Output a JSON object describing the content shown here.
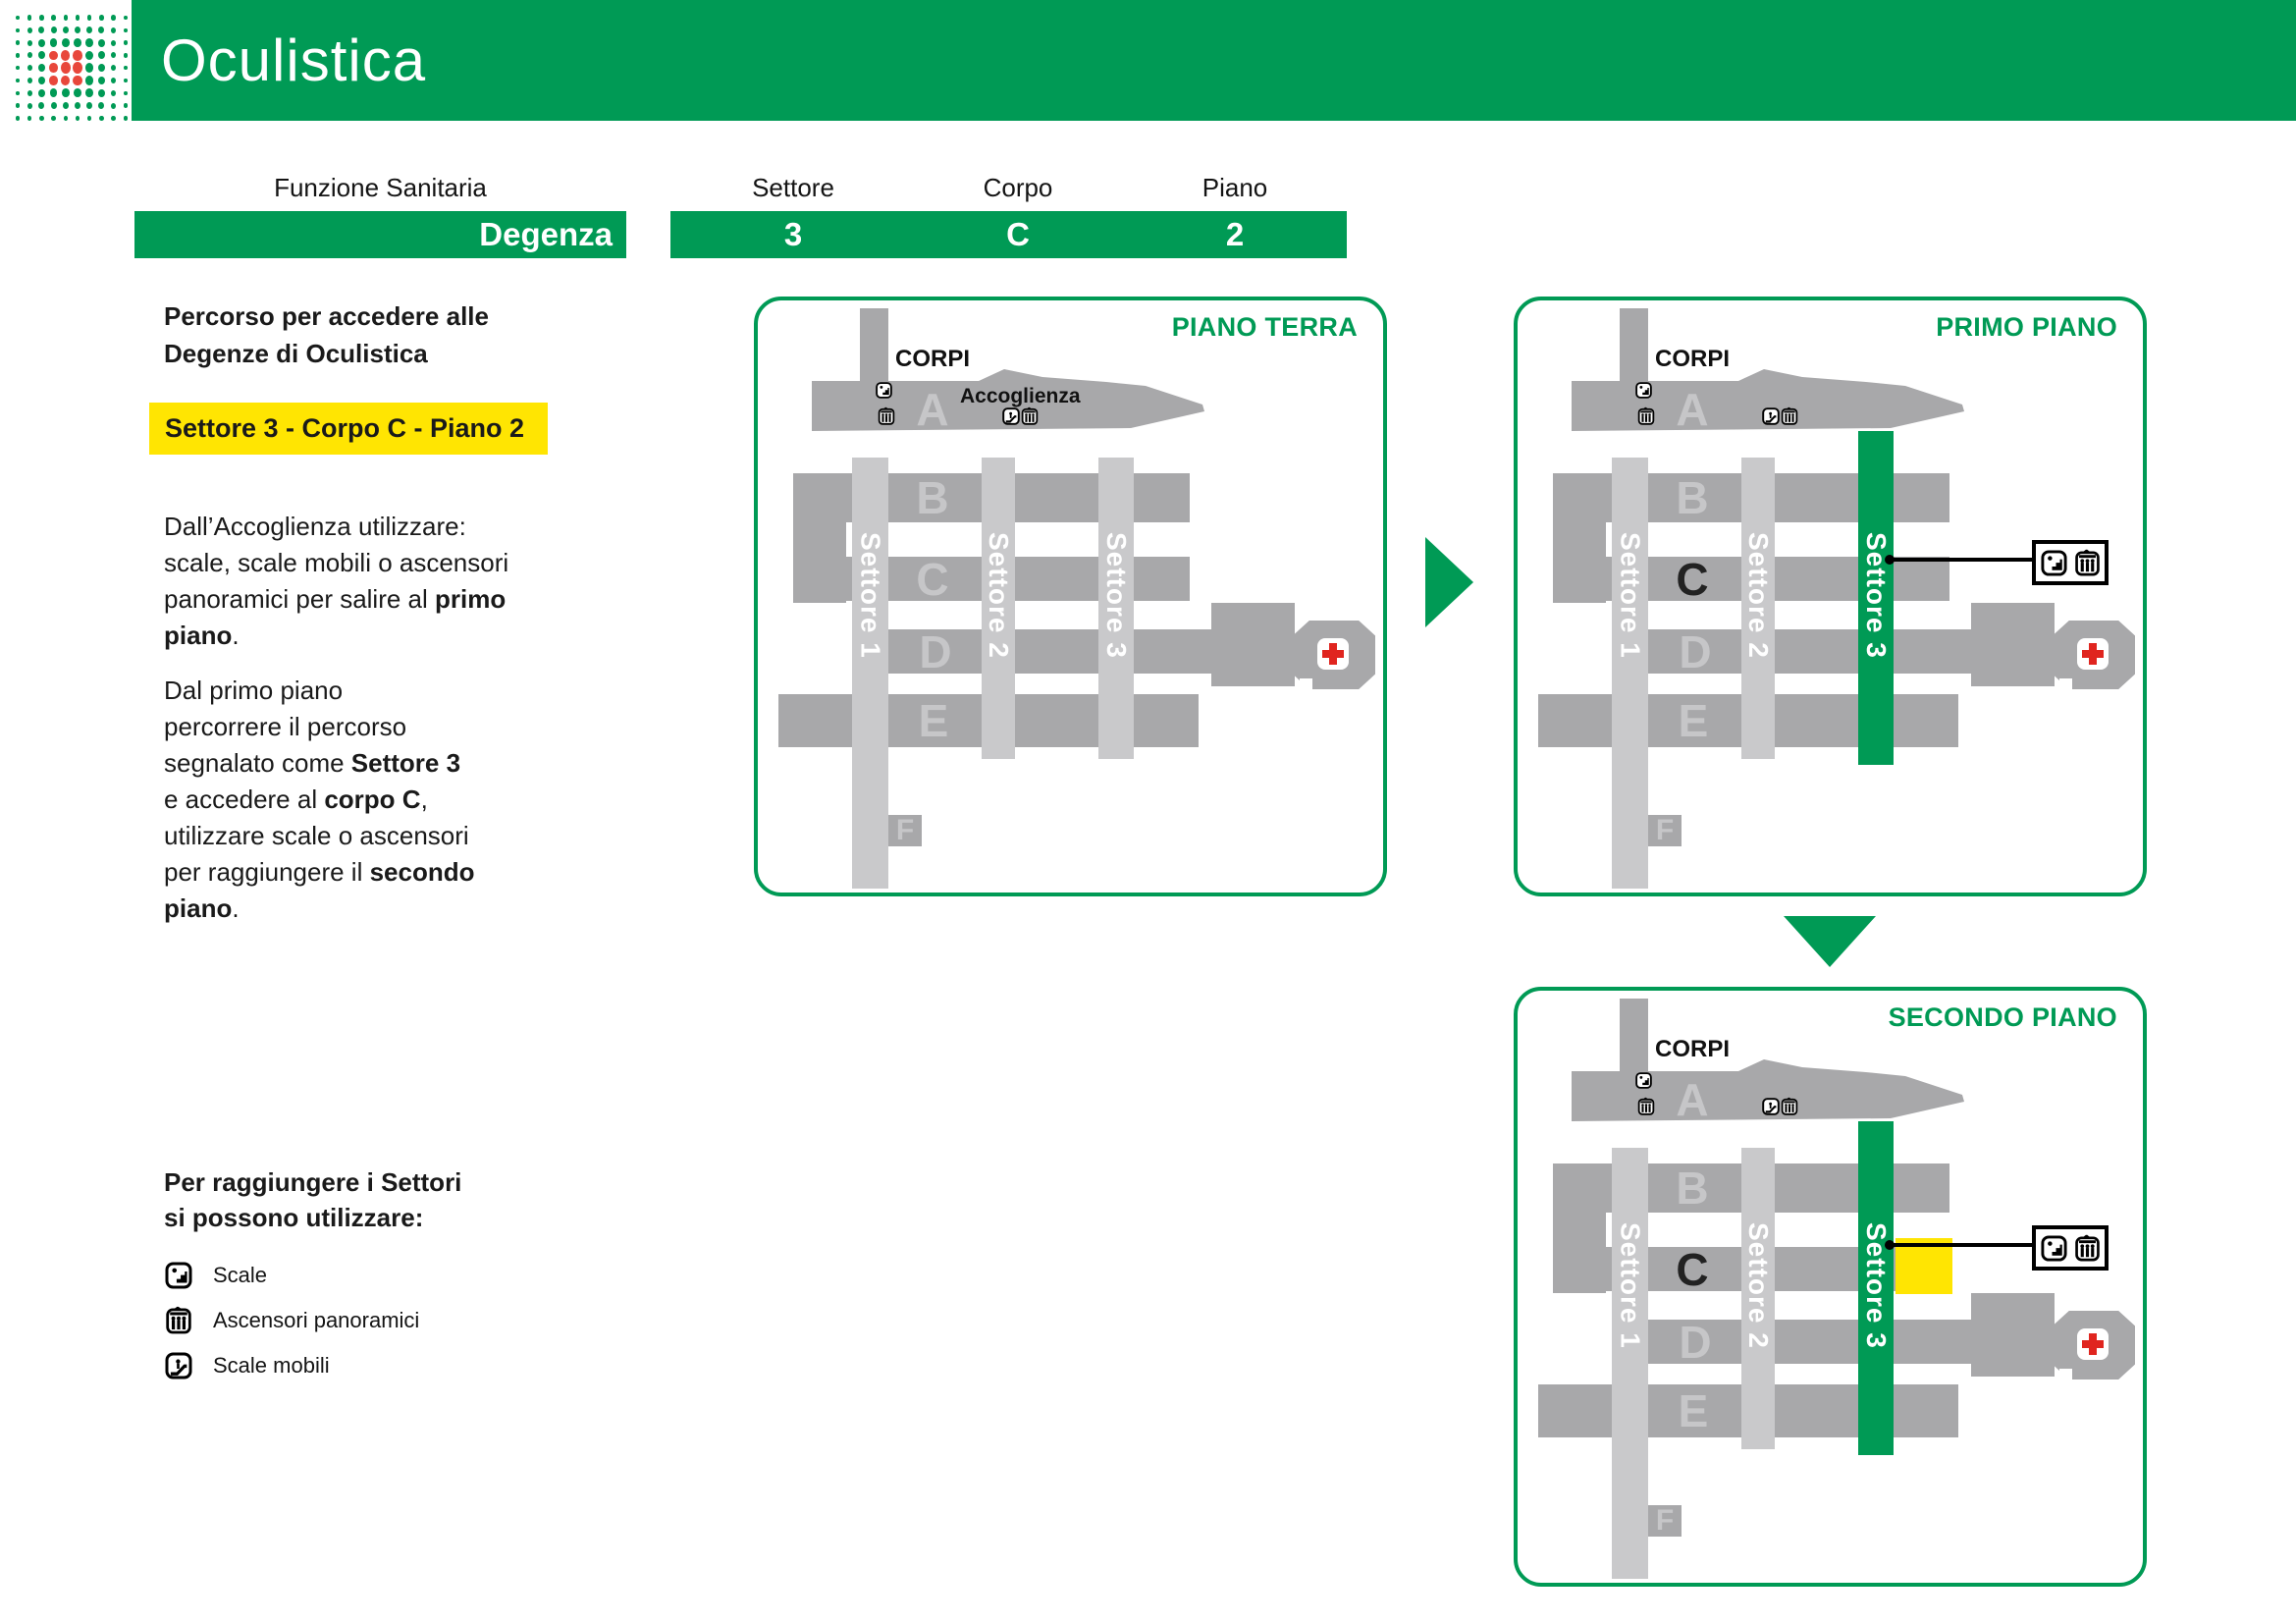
{
  "header": {
    "title": "Oculistica"
  },
  "table": {
    "function_header": "Funzione Sanitaria",
    "function_value": "Degenza",
    "location_headers": [
      "Settore",
      "Corpo",
      "Piano"
    ],
    "location_values": [
      "3",
      "C",
      "2"
    ]
  },
  "sidebar": {
    "heading_lines": [
      "Percorso per accedere alle",
      "Degenze di Oculistica"
    ],
    "highlight": "Settore 3 - Corpo C - Piano 2",
    "para1_lines": [
      [
        [
          "Dall’Accoglienza utilizzare:",
          0
        ]
      ],
      [
        [
          "scale, scale mobili o ascensori",
          0
        ]
      ],
      [
        [
          "panoramici per salire al ",
          0
        ],
        [
          "primo",
          1
        ]
      ],
      [
        [
          "piano",
          1
        ],
        [
          ".",
          0
        ]
      ]
    ],
    "para2_lines": [
      [
        [
          "Dal primo piano",
          0
        ]
      ],
      [
        [
          "percorrere il percorso",
          0
        ]
      ],
      [
        [
          "segnalato come ",
          0
        ],
        [
          "Settore 3",
          1
        ]
      ],
      [
        [
          "e accedere al ",
          0
        ],
        [
          "corpo C",
          1
        ],
        [
          ",",
          0
        ]
      ],
      [
        [
          "utilizzare scale o ascensori",
          0
        ]
      ],
      [
        [
          "per raggiungere il ",
          0
        ],
        [
          "secondo",
          1
        ]
      ],
      [
        [
          "piano",
          1
        ],
        [
          ".",
          0
        ]
      ]
    ],
    "legend_heading_lines": [
      "Per raggiungere i Settori",
      "si possono utilizzare:"
    ],
    "legend": [
      {
        "icon": "stairs-icon",
        "label": "Scale"
      },
      {
        "icon": "panoramic-elevator-icon",
        "label": "Ascensori panoramici"
      },
      {
        "icon": "escalator-icon",
        "label": "Scale mobili"
      }
    ]
  },
  "floors": [
    {
      "title": "PIANO TERRA"
    },
    {
      "title": "PRIMO PIANO"
    },
    {
      "title": "SECONDO PIANO"
    }
  ],
  "map": {
    "corpi_label": "CORPI",
    "accoglienza_label": "Accoglienza",
    "letters": [
      "A",
      "B",
      "C",
      "D",
      "E",
      "F"
    ],
    "sectors": [
      "Settore 1",
      "Settore 2",
      "Settore 3"
    ]
  },
  "colors": {
    "green": "#009a55",
    "band_gray": "#a8a8aa",
    "strip_gray": "#c9c9cb",
    "letter_gray": "#c6c6c8",
    "yellow": "#ffe502",
    "cross_red": "#e0251f",
    "logo_red": "#e8473b"
  }
}
